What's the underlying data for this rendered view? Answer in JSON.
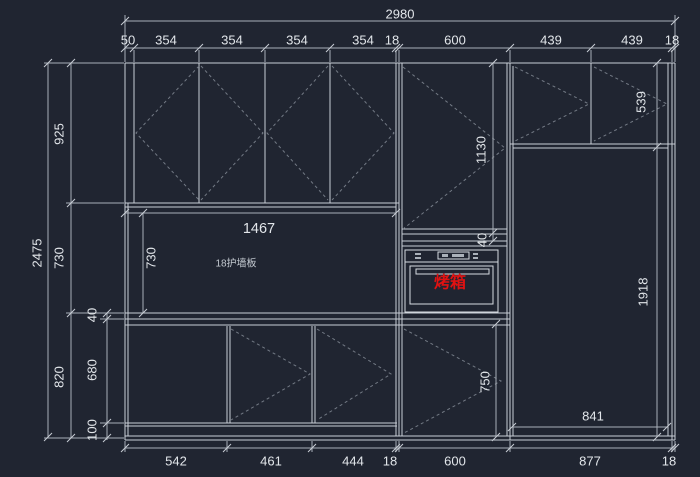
{
  "colors": {
    "background": "#202531",
    "line": "#c9cfd6",
    "dashed_door_marks": "#737a85",
    "dimension": "#a9b0b9",
    "text": "#e2e6ea",
    "oven_label": "#e01212"
  },
  "labels": {
    "wall_panel": "18护墙板",
    "oven": "烤箱"
  },
  "dims": {
    "total_width": "2980",
    "top": [
      "50",
      "354",
      "354",
      "354",
      "354",
      "18",
      "600",
      "439",
      "439",
      "18"
    ],
    "left_total": "2475",
    "left": [
      "925",
      "730",
      "820"
    ],
    "left_sub": [
      "40",
      "680",
      "100"
    ],
    "bottom": [
      "542",
      "461",
      "444",
      "18",
      "600",
      "877",
      "18"
    ],
    "inner": {
      "back_panel_w": "1467",
      "back_panel_h": "730",
      "tall_door_h": "1130",
      "gap": "40",
      "upper_right_h": "539",
      "tall_right_h": "1918",
      "base_right_h": "750",
      "inner_w": "841"
    }
  }
}
